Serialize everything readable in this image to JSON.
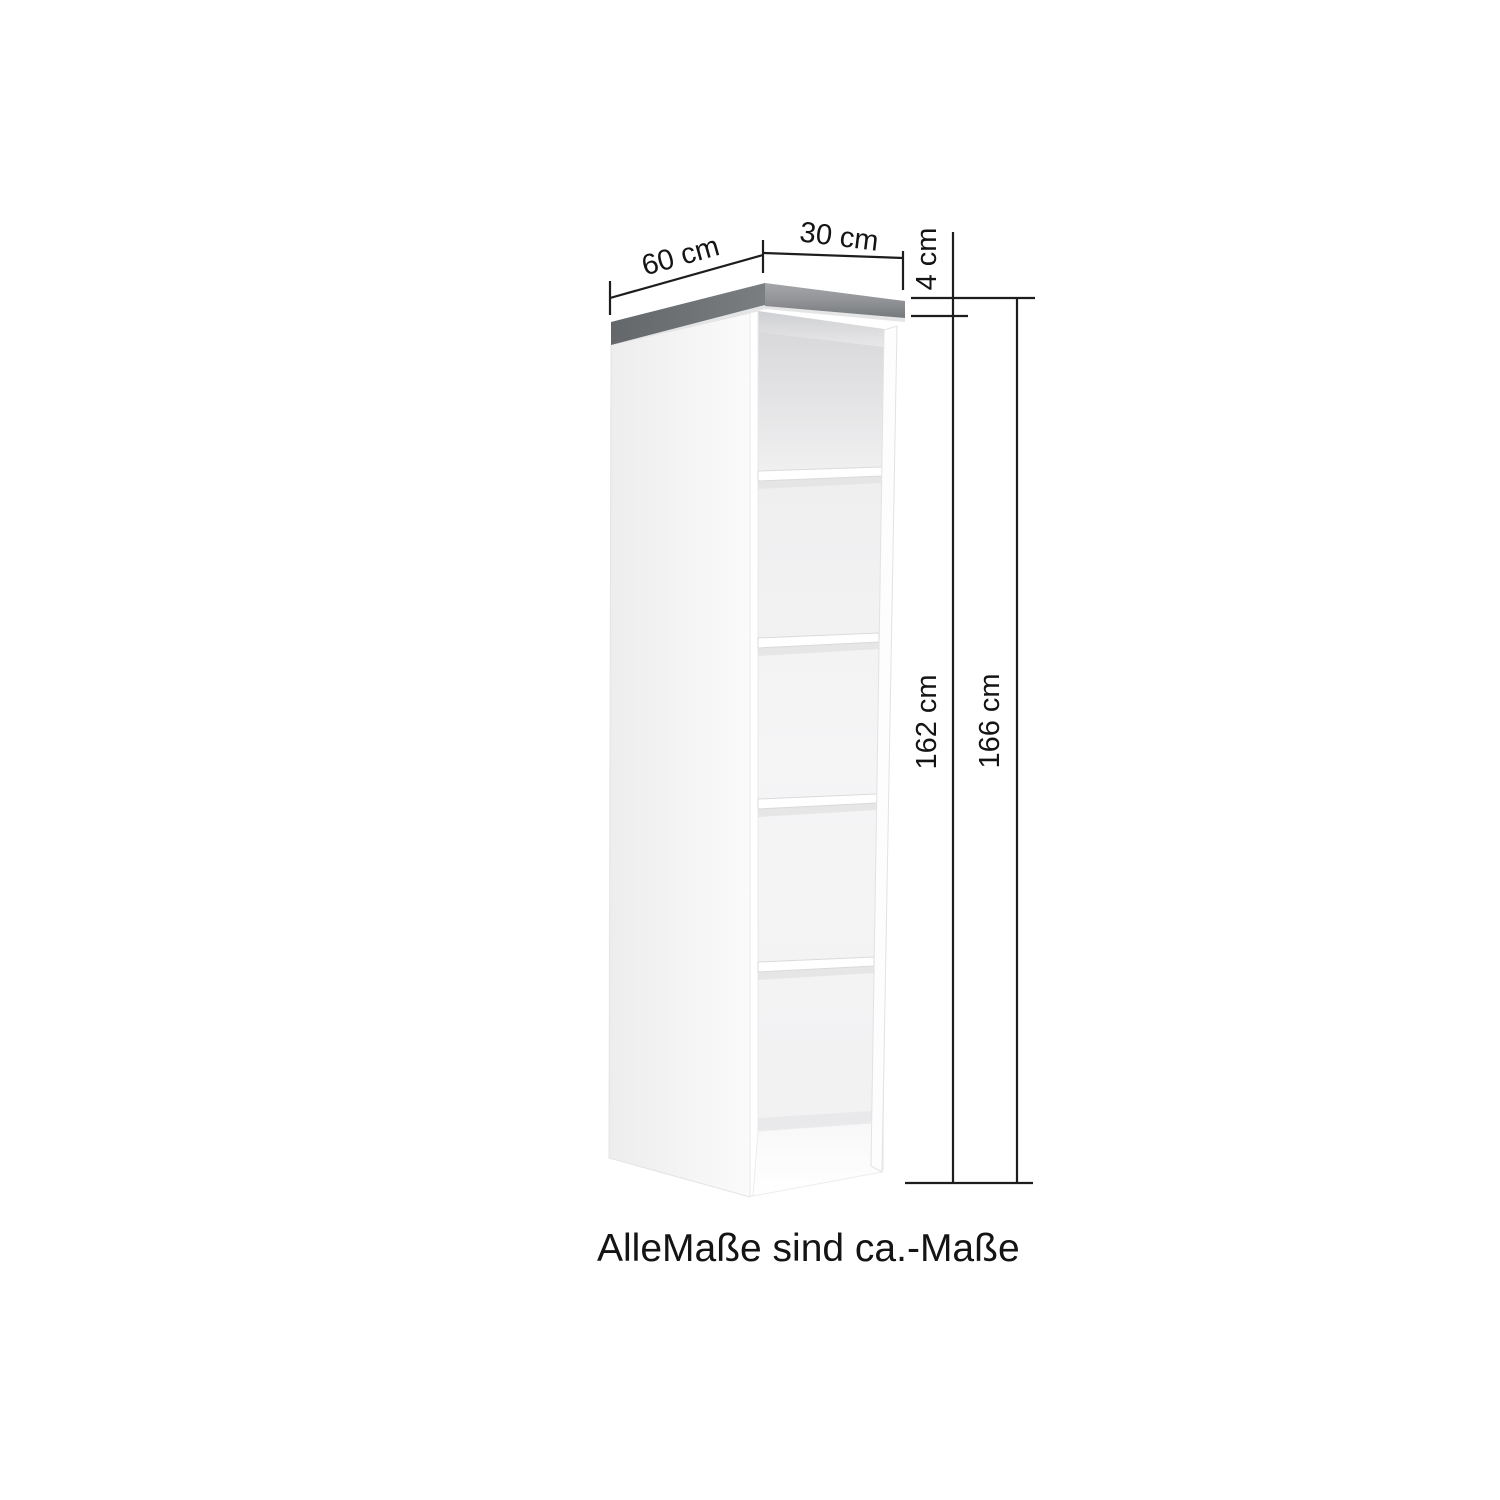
{
  "diagram": {
    "caption": "AlleMaße sind ca.-Maße",
    "unit": "cm",
    "dimension_labels": {
      "depth": "60 cm",
      "width": "30 cm",
      "worktop_thickness": "4 cm",
      "carcass_height": "162 cm",
      "total_height": "166 cm"
    },
    "shelf_count": 4,
    "colors": {
      "worktop_dark_edge": "#6f7274",
      "worktop_light_top": "#a0a2a4",
      "cabinet_white": "#fafafa",
      "interior_shadow": "#dcdcde",
      "dimension_line": "#1d1d1f",
      "text": "#141414",
      "background": "#ffffff"
    }
  }
}
